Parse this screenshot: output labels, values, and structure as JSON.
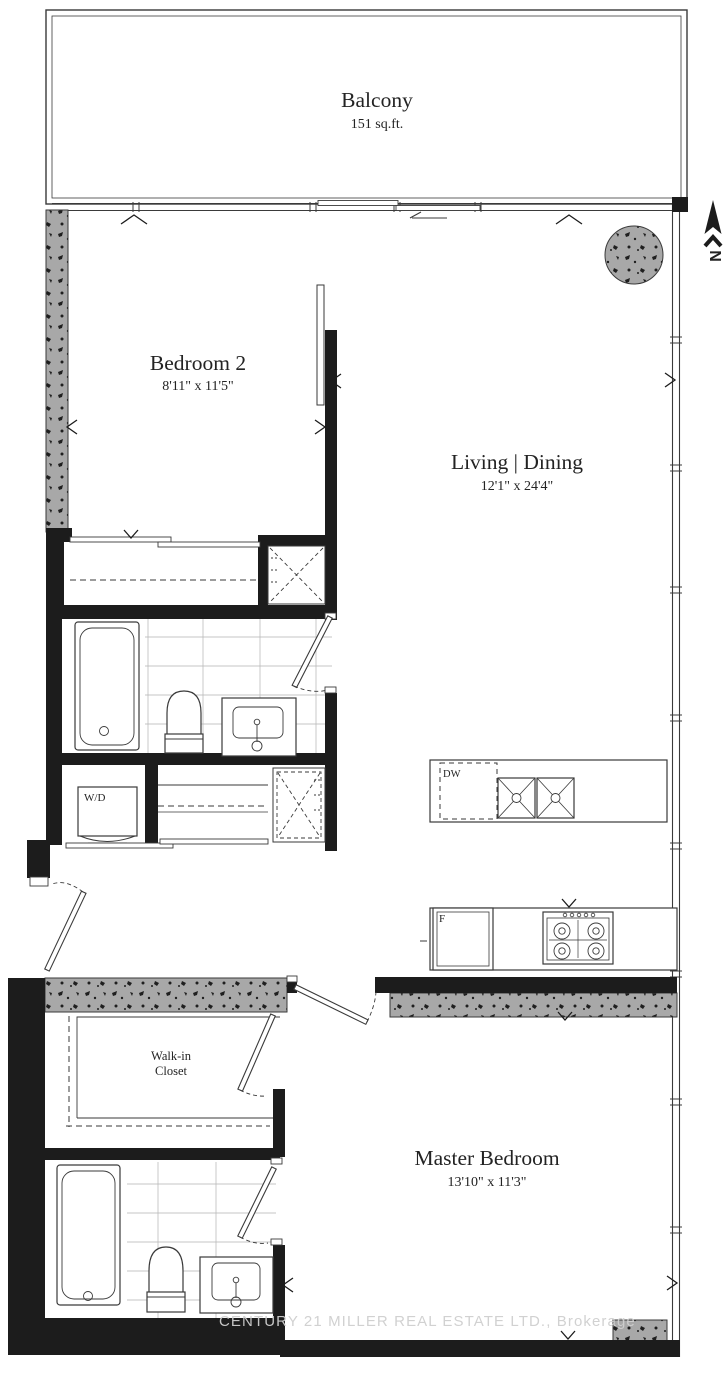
{
  "rooms": {
    "balcony": {
      "name": "Balcony",
      "area": "151 sq.ft."
    },
    "bedroom2": {
      "name": "Bedroom 2",
      "dims": "8'11\" x 11'5\""
    },
    "living_dining": {
      "name": "Living | Dining",
      "dims": "12'1\" x 24'4\""
    },
    "walk_in_closet": {
      "name_line1": "Walk-in",
      "name_line2": "Closet"
    },
    "master_bedroom": {
      "name": "Master Bedroom",
      "dims": "13'10\" x 11'3\""
    }
  },
  "labels": {
    "washer_dryer": "W/D",
    "dishwasher": "DW",
    "fridge": "F",
    "north": "N"
  },
  "watermark": "CENTURY 21 MILLER REAL ESTATE LTD., Brokerage",
  "colors": {
    "background": "#ffffff",
    "wall": "#1c1c1c",
    "concrete": "#a8a8a8",
    "speckle": "#1f1f1f",
    "line": "#3a3a3a",
    "tile": "#b4b4b4",
    "text": "#232323",
    "watermark": "#cfcfcf"
  }
}
